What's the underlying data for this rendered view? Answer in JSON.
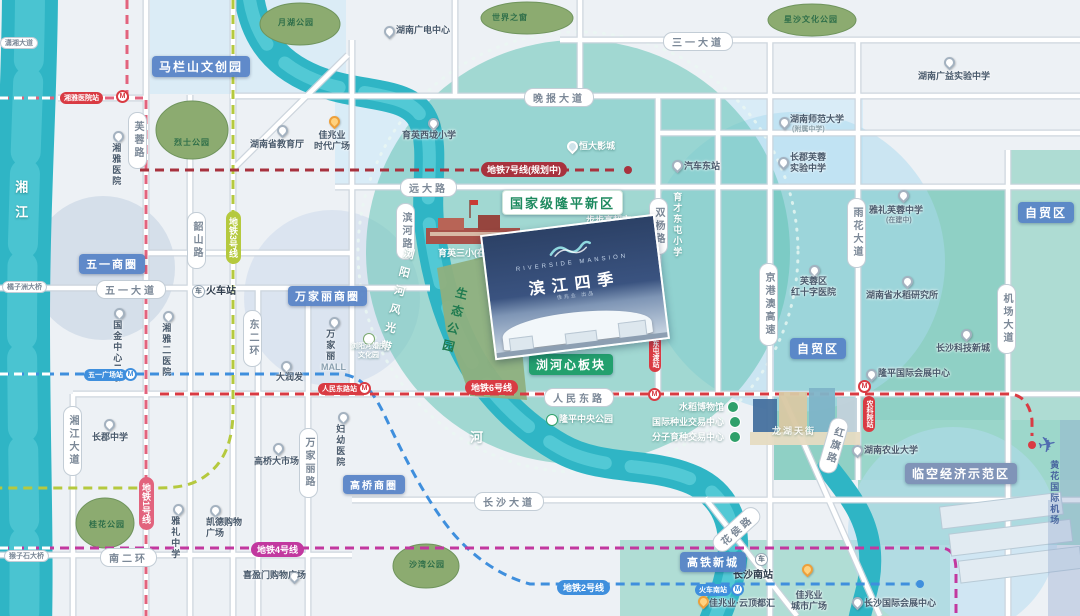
{
  "rivers": {
    "xiangjiang": "湘江",
    "liuyanghe_belt": "浏阳河风光带",
    "he_char": "河"
  },
  "roads": {
    "sanyi_dadao": "三一大道",
    "wanbao_dadao": "晚报大道",
    "yuanda_lu": "远大路",
    "wuyi_dadao": "五一大道",
    "renmin_donglu": "人民东路",
    "changsha_dadao": "长沙大道",
    "nan_erhuan": "南二环",
    "xiaoxiang_dadao": "潇湘大道",
    "juzizhou_bridge": "橘子洲大桥",
    "houzishi_bridge": "猴子石大桥",
    "furong_lu": "芙蓉路",
    "shaoshan_lu": "韶山路",
    "dong_erhuan": "东二环",
    "wanjiali_lu": "万家丽路",
    "xiangjiang_dadao": "湘江大道",
    "binhe_lu": "滨河路",
    "shuangyang_lu": "双杨路",
    "jinggangao": "京港澳高速",
    "yuhua_dadao": "雨花大道",
    "jichang_dadao": "机场大道",
    "hongqi_lu": "红旗路",
    "huahou_lu": "花侯路"
  },
  "districts": {
    "malanshan": "马栏山文创园",
    "wuyi_shangquan": "五一商圈",
    "wanjiali_shangquan": "万家丽商圈",
    "gaoqiao_shangquan": "高桥商圈",
    "gaotie_xincheng": "高铁新城",
    "zimaoqu_ne": "自贸区",
    "zimaoqu_mid": "自贸区",
    "linkong": "临空经济示范区",
    "longping_newarea": "国家级隆平新区",
    "liuhexin": "浏河心板块"
  },
  "metro": {
    "line1": "地铁1号线",
    "line2": "地铁2号线",
    "line3": "地铁3号线",
    "line4": "地铁4号线",
    "line6": "地铁6号线",
    "line7": "地铁7号线(规划中)"
  },
  "stations": {
    "xiangya_hospital": "湘雅医院站",
    "wuyi_square": "五一广场站",
    "renmin_donglu": "人民东路站",
    "dongtundu": "东屯渡站",
    "nongkeyuan": "农科院站",
    "huoche_nanzhan": "火车南站"
  },
  "parks": {
    "yuehu": "月湖公园",
    "shijiezhichuang": "世界之窗",
    "xingsha_culture": "星沙文化公园",
    "lieshi": "烈士公园",
    "guihua": "桂花公园",
    "shawan": "沙湾公园"
  },
  "pois": {
    "hunan_tv": "湖南广电中心",
    "guangyi_school": "湖南广益实验中学",
    "shida": "湖南师范大学",
    "shida_sub": "(附属中学)",
    "changjun_furong": "长郡芙蓉\n实验中学",
    "qiche_dongzhan": "汽车东站",
    "jiaoyuting": "湖南省教育厅",
    "jiazhaoye_shidai": "佳兆业\n时代广场",
    "xiangya_hospital": "湘雅医院",
    "yuying_xilong": "育英西垅小学",
    "hengda_cinema": "恒大影城",
    "yuying_sanxiao": "育英三小(在建)",
    "bubugao": "步步高超市",
    "yucai_dongtun": "育才东屯小学",
    "yali_furong": "雅礼芙蓉中学",
    "yali_furong_sub": "(在建中)",
    "hongshizi_hospital": "芙蓉区\n红十字医院",
    "shuidao_institute": "湖南省水稻研究所",
    "keji_xincheng": "长沙科技新城",
    "longping_exhibition": "隆平国际会展中心",
    "nongye_university": "湖南农业大学",
    "longhu_tianjie": "龙湖天街",
    "shuidao_museum": "水稻博物馆",
    "zhongye_center": "国际种业交易中心",
    "fenzi_center": "分子育种交易中心",
    "longping_park": "隆平中央公园",
    "hunqing_park": "浏阳河婚庆\n文化园",
    "huochezhan": "火车站",
    "guojin_ifs": "国金中心IFS",
    "xiangya_er": "湘雅二医院",
    "darunfa": "大润发",
    "wanjiali_mall_cn": "万家丽",
    "wanjiali_mall_en": "MALL",
    "gaoqiao_market": "高桥大市场",
    "fuyou_hospital": "妇幼医院",
    "changjun_school": "长郡中学",
    "yali_school": "雅礼中学",
    "kaide_plaza": "凯德购物\n广场",
    "xiyingmen": "喜盈门购物广场",
    "changsha_nanzhan": "长沙南站",
    "jzy_yunding": "佳兆业·云顶都汇",
    "jzy_plaza": "佳兆业\n城市广场",
    "guoji_exhibition": "长沙国际会展中心",
    "shengtai_park": "生态公园"
  },
  "project": {
    "brand_en": "RIVERSIDE MANSION",
    "brand_cn": "滨江四季",
    "brand_sub": "佳兆业 出品"
  },
  "airport": {
    "name": "黄花国际机场"
  },
  "colors": {
    "river": "#2fb5c5",
    "zone_teal": "#63c2b5",
    "badge_blue": "#5682c6",
    "badge_green": "#23a06e",
    "metro_line1": "#e2637d",
    "metro_line2": "#3f8fdd",
    "metro_line3": "#b5c93e",
    "metro_line4": "#c2389f",
    "metro_line6": "#d93b43",
    "metro_line7": "#a8323e"
  }
}
